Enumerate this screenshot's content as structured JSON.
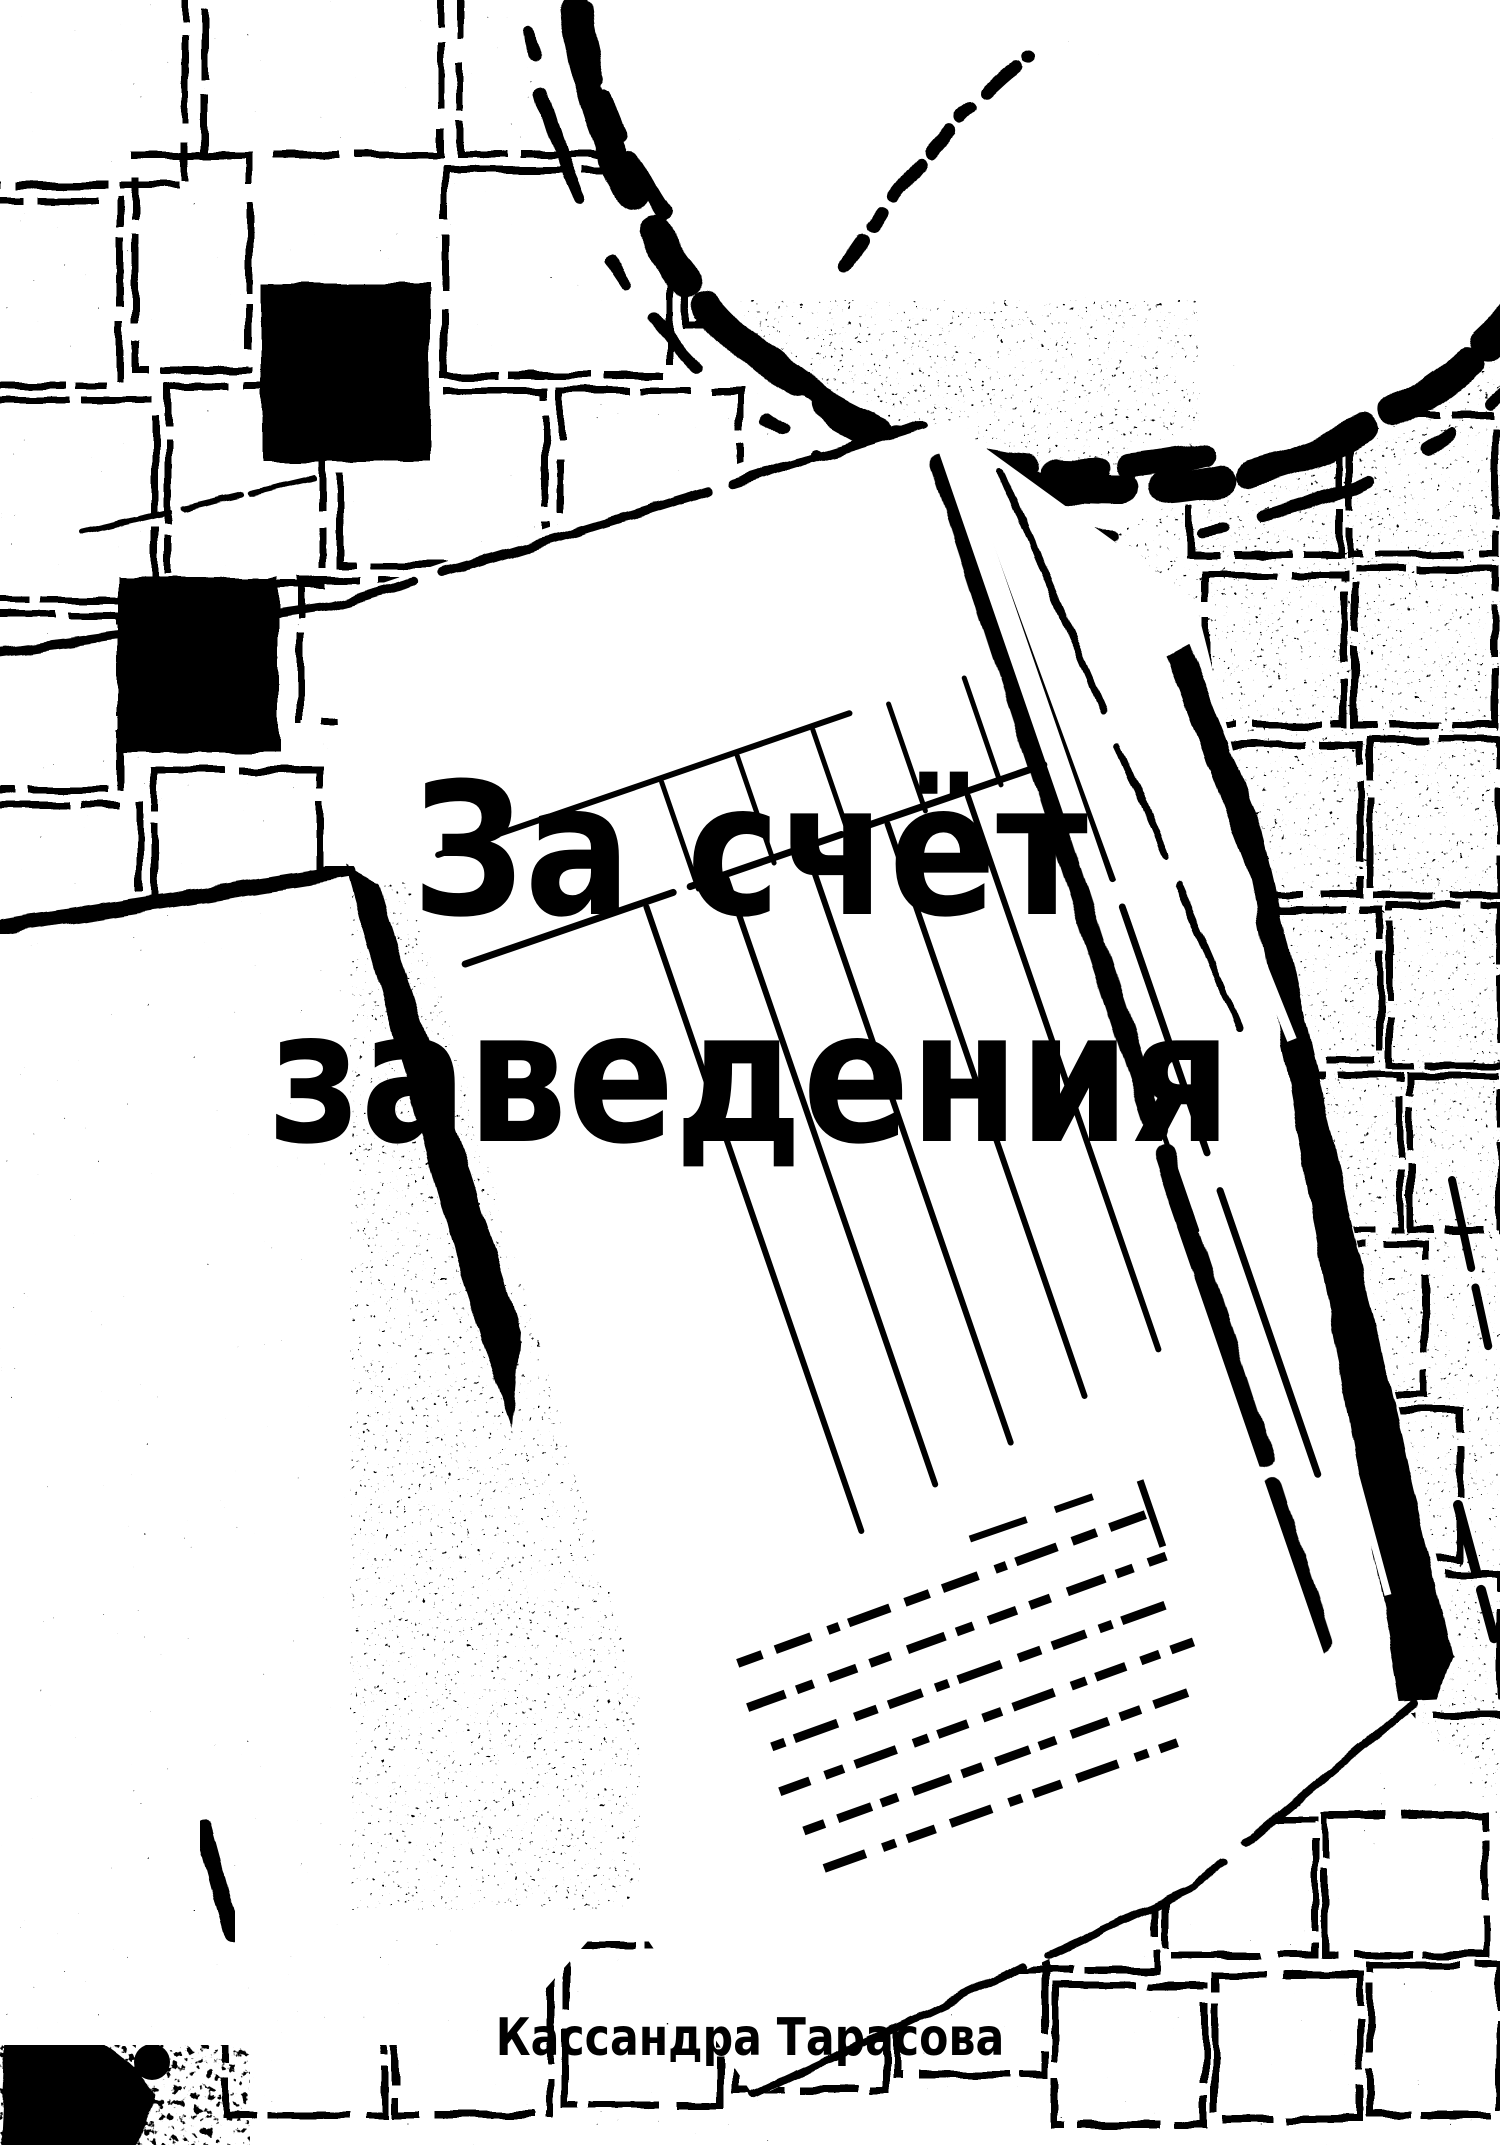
{
  "page": {
    "kind": "book-cover",
    "paper": "#ffffff",
    "ink": "#000000"
  },
  "cover": {
    "title": {
      "line1": "За счёт",
      "line2": "заведения"
    },
    "author": "Кассандра Тарасова",
    "illustration": {
      "style": "high-contrast thresholded black-and-white photo",
      "elements": [
        "mosaic-tile-wall",
        "saucer-and-cup",
        "receipt-form",
        "stamp-dashed-block",
        "menu-folder",
        "pen"
      ]
    }
  }
}
